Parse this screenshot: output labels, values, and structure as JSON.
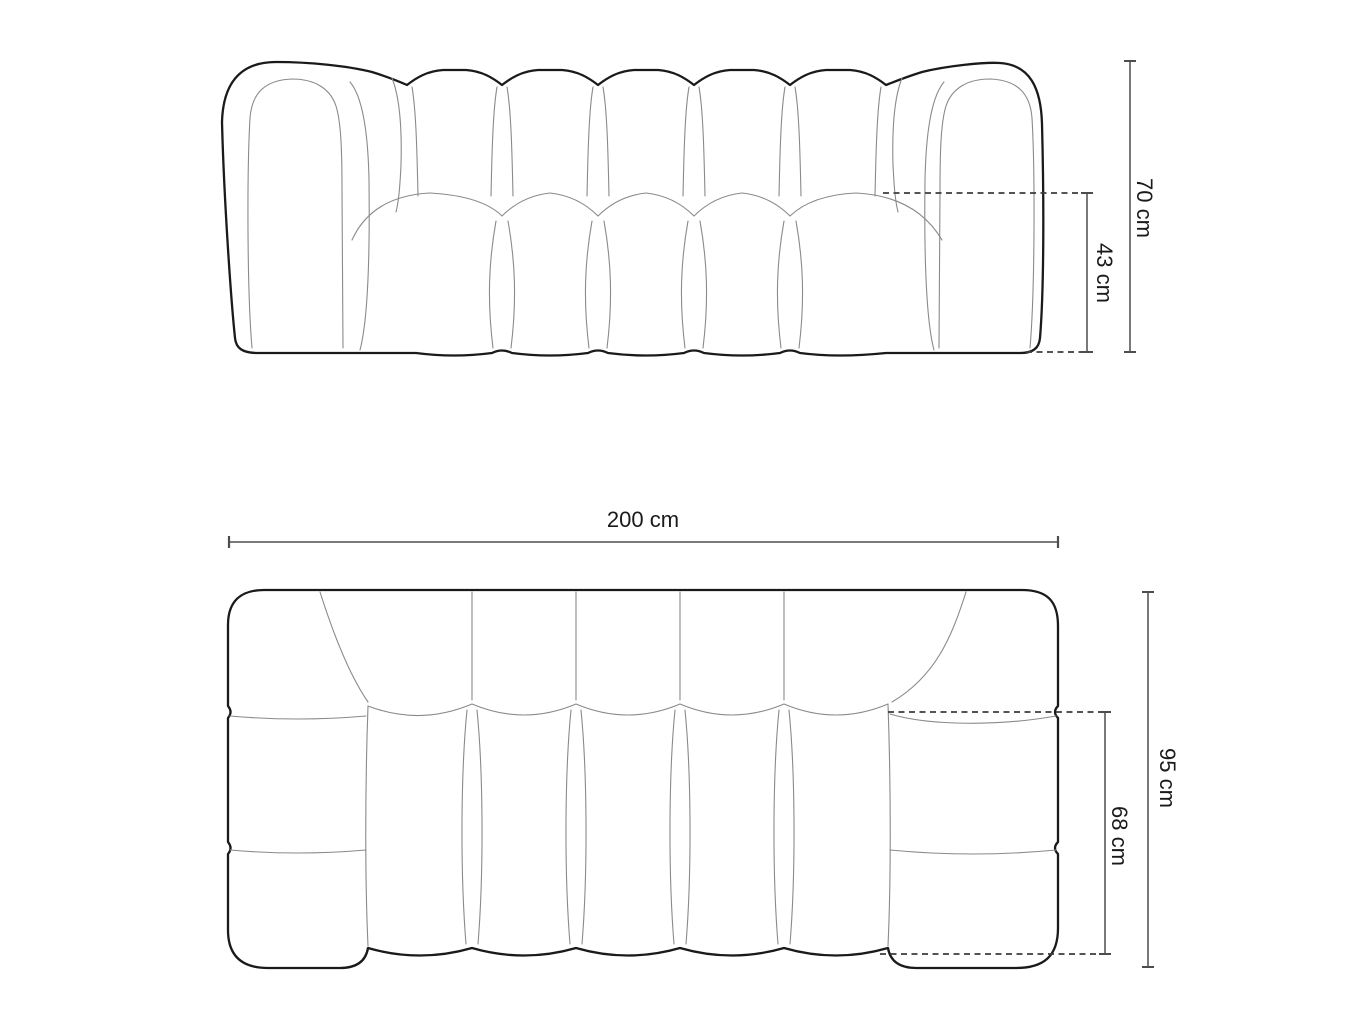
{
  "page": {
    "background": "#ffffff"
  },
  "diagram": {
    "type": "furniture-dimension-drawing",
    "subject": "modular tufted sofa, two orthographic views",
    "views": [
      {
        "id": "front",
        "name": "front elevation view",
        "dimension_labels": [
          "70 cm",
          "43 cm"
        ]
      },
      {
        "id": "top",
        "name": "top plan view",
        "dimension_labels": [
          "200 cm",
          "95 cm",
          "68 cm"
        ]
      }
    ],
    "labels": {
      "front_total_height": "70 cm",
      "front_seat_height": "43 cm",
      "top_total_width": "200 cm",
      "top_total_depth": "95 cm",
      "top_seat_depth": "68 cm"
    },
    "colors": {
      "outline": "#1a1a1a",
      "seam": "#8a8a8a",
      "dimension_line": "#4d4d4d",
      "dimension_line_light": "#7a7a7a",
      "dashed_line": "#3c3c3c",
      "text": "#1a1a1a",
      "background": "#ffffff"
    }
  }
}
